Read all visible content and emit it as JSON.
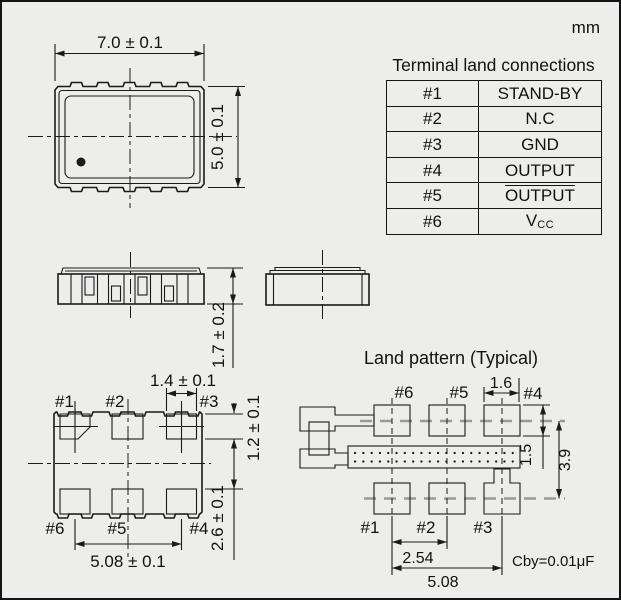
{
  "units_label": "mm",
  "terminal_table": {
    "title": "Terminal land connections",
    "rows": [
      {
        "pin": "#1",
        "value": "STAND-BY"
      },
      {
        "pin": "#2",
        "value": "N.C"
      },
      {
        "pin": "#3",
        "value": "GND"
      },
      {
        "pin": "#4",
        "value": "OUTPUT"
      },
      {
        "pin": "#5",
        "value": "OUTPUT"
      },
      {
        "pin": "#6",
        "value": "V",
        "value_sub": "CC"
      }
    ]
  },
  "top_view": {
    "width_dim": "7.0 ± 0.1",
    "height_dim": "5.0 ± 0.1"
  },
  "side_view": {
    "thickness_dim": "1.7 ± 0.2"
  },
  "bottom_view": {
    "pad_labels_top": [
      "#1",
      "#2",
      "#3"
    ],
    "pad_labels_bottom": [
      "#6",
      "#5",
      "#4"
    ],
    "pad_width_dim": "1.4 ± 0.1",
    "pad_length_dim": "1.2 ± 0.1",
    "pad_gap_dim": "2.6 ± 0.1",
    "pad_span_dim": "5.08 ± 0.1"
  },
  "land_pattern": {
    "title": "Land pattern (Typical)",
    "pad_labels_top": [
      "#6",
      "#5",
      "#4"
    ],
    "pad_labels_bottom": [
      "#1",
      "#2",
      "#3"
    ],
    "pad_width_dim": "1.6",
    "pad_height_dim": "1.5",
    "row_spacing_dim": "3.9",
    "pad_pitch_dim": "2.54",
    "pad_span_dim": "5.08",
    "capacitor_note": "Cby=0.01μF"
  }
}
